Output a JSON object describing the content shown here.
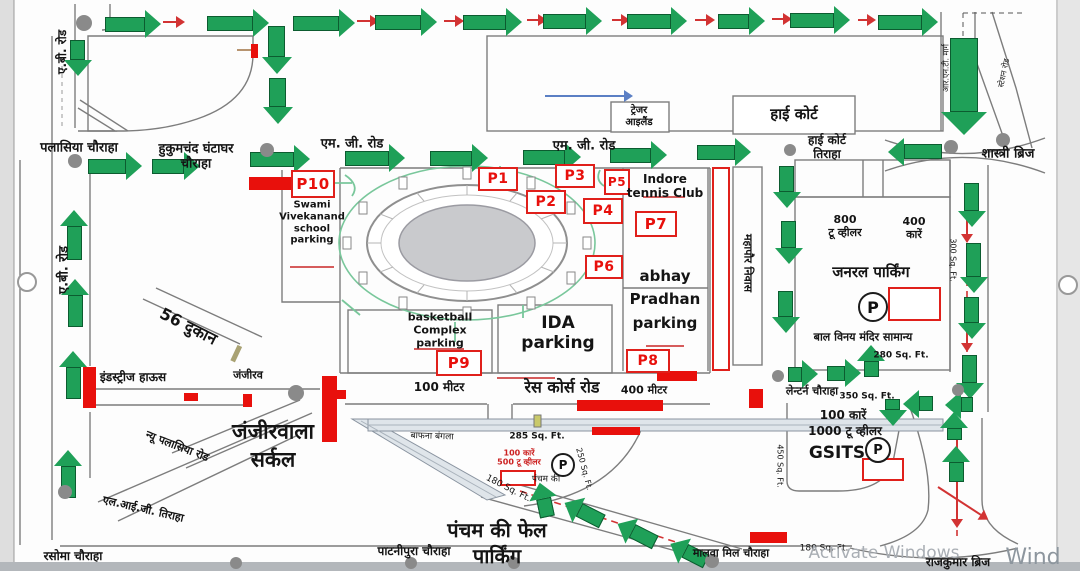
{
  "map": {
    "colors": {
      "arrow_green": "#1fa058",
      "arrow_green_dark": "#0c5c30",
      "barricade_red": "#e8100c",
      "dash_red": "#d23333",
      "flow_blue": "#5b7fc4",
      "island_gray": "#8a8a8a",
      "watermark_gray": "#a9aeb4"
    },
    "labels": [
      {
        "n": "label-ab-road-top",
        "t": "ए.बी. रोड",
        "x": 62,
        "y": 52,
        "fs": 12,
        "rot": -90,
        "fw": 700
      },
      {
        "n": "label-ab-road",
        "t": "ए.बी. रोड",
        "x": 64,
        "y": 270,
        "fs": 13,
        "rot": -90,
        "fw": 700
      },
      {
        "n": "label-palasia-chauraha",
        "t": "पलासिया चौराहा",
        "x": 79,
        "y": 148,
        "fs": 13,
        "fw": 700
      },
      {
        "n": "label-hukumchand-ghantaghar-chauraha",
        "t": "हुकुमचंद घंटाघर\nचौराहा",
        "x": 196,
        "y": 157,
        "fs": 13,
        "fw": 700
      },
      {
        "n": "label-mg-road-1",
        "t": "एम. जी. रोड",
        "x": 352,
        "y": 144,
        "fs": 13,
        "fw": 700
      },
      {
        "n": "label-mg-road-2",
        "t": "एम. जी. रोड",
        "x": 584,
        "y": 146,
        "fs": 13,
        "fw": 700
      },
      {
        "n": "label-treasure-island",
        "t": "ट्रेजर\nआइलैंड",
        "x": 639,
        "y": 117,
        "fs": 10,
        "fw": 700
      },
      {
        "n": "label-high-court",
        "t": "हाई कोर्ट",
        "x": 794,
        "y": 115,
        "fs": 15,
        "fw": 700
      },
      {
        "n": "label-high-court-tiraha",
        "t": "हाई कोर्ट\nतिराहा",
        "x": 827,
        "y": 147,
        "fs": 12,
        "fw": 700
      },
      {
        "n": "label-shastri-bridge",
        "t": "शास्त्री ब्रिज",
        "x": 1008,
        "y": 154,
        "fs": 13,
        "fw": 700
      },
      {
        "n": "label-rnt-marg",
        "t": "आर.एन.टी. मार्ग",
        "x": 946,
        "y": 68,
        "fs": 8,
        "rot": -90
      },
      {
        "n": "label-station-road",
        "t": "स्टेशन रोड",
        "x": 1004,
        "y": 73,
        "fs": 8,
        "rot": -78
      },
      {
        "n": "label-mahapaur-niwas",
        "t": "महापौर निवास",
        "x": 747,
        "y": 263,
        "fs": 11,
        "rot": 90,
        "fw": 700
      },
      {
        "n": "label-indore-tennis-club",
        "t": "Indore\ntennis Club",
        "x": 665,
        "y": 186,
        "fs": 12,
        "fw": 700
      },
      {
        "n": "label-abhay-pradhan-parking",
        "t": "abhay\nPradhan\nparking",
        "x": 665,
        "y": 300,
        "fs": 15,
        "fw": 700,
        "lh": 1.55
      },
      {
        "n": "label-ida-parking",
        "t": "IDA\nparking",
        "x": 558,
        "y": 333,
        "fs": 17,
        "fw": 700
      },
      {
        "n": "label-basketball-complex-parking",
        "t": "basketball\nComplex\nparking",
        "x": 440,
        "y": 331,
        "fs": 11,
        "fw": 700
      },
      {
        "n": "label-swami-vivekanand-school-parking",
        "t": "Swami\nVivekanand\nschool\nparking",
        "x": 312,
        "y": 223,
        "fs": 10,
        "fw": 700
      },
      {
        "n": "label-800-two-wheeler",
        "t": "800\nटू व्हीलर",
        "x": 845,
        "y": 227,
        "fs": 11,
        "fw": 700
      },
      {
        "n": "label-400-cars",
        "t": "400\nकारें",
        "x": 914,
        "y": 229,
        "fs": 11,
        "fw": 700
      },
      {
        "n": "label-general-parking",
        "t": "जनरल पार्किंग",
        "x": 871,
        "y": 273,
        "fs": 15,
        "fw": 700
      },
      {
        "n": "label-bal-vinay-mandir-samanya",
        "t": "बाल विनय मंदिर सामान्य",
        "x": 863,
        "y": 338,
        "fs": 11,
        "fw": 700
      },
      {
        "n": "label-280-sqft",
        "t": "280 Sq. Ft.",
        "x": 901,
        "y": 356,
        "fs": 9,
        "fw": 700
      },
      {
        "n": "label-300-sqft",
        "t": "300 Sq. Ft.",
        "x": 953,
        "y": 260,
        "fs": 8,
        "rot": 90
      },
      {
        "n": "label-56-dukan",
        "t": "56 दुकान",
        "x": 188,
        "y": 327,
        "fs": 16,
        "rot": 27,
        "fw": 700
      },
      {
        "n": "label-industries-house",
        "t": "इंडस्ट्रीज हाऊस",
        "x": 133,
        "y": 377,
        "fs": 12,
        "fw": 700
      },
      {
        "n": "label-janjeer-street",
        "t": "जंजीरव",
        "x": 248,
        "y": 376,
        "fs": 11,
        "fw": 700
      },
      {
        "n": "label-janjeerwala-circle",
        "t": "जंजीरवाला\nसर्कल",
        "x": 273,
        "y": 446,
        "fs": 21,
        "fw": 700,
        "lh": 1.35
      },
      {
        "n": "label-new-palasia-road",
        "t": "न्यू पलासिया रोड",
        "x": 177,
        "y": 447,
        "fs": 11,
        "rot": 21,
        "fw": 700
      },
      {
        "n": "label-lig-tiraha",
        "t": "एल.आई.जी. तिराहा",
        "x": 143,
        "y": 510,
        "fs": 11,
        "rot": 13,
        "fw": 700
      },
      {
        "n": "label-rasoma-chauraha",
        "t": "रसोमा चौराहा",
        "x": 73,
        "y": 556,
        "fs": 12,
        "fw": 700
      },
      {
        "n": "label-patnipura-chauraha",
        "t": "पाटनीपुरा चौराहा",
        "x": 414,
        "y": 551,
        "fs": 12,
        "fw": 700
      },
      {
        "n": "label-pancham-ki-phel-parking",
        "t": "पंचम की फेल\nपार्किंग",
        "x": 497,
        "y": 543,
        "fs": 20,
        "fw": 700,
        "lh": 1.3
      },
      {
        "n": "label-malwa-mill-chauraha",
        "t": "मालवा मिल चौराहा",
        "x": 731,
        "y": 554,
        "fs": 11,
        "fw": 700
      },
      {
        "n": "label-rajkumar-bridge",
        "t": "राजकुमार ब्रिज",
        "x": 958,
        "y": 562,
        "fs": 12,
        "fw": 700
      },
      {
        "n": "label-race-course-road",
        "t": "रेस कोर्स रोड",
        "x": 562,
        "y": 388,
        "fs": 16,
        "fw": 700
      },
      {
        "n": "label-100-meter",
        "t": "100 मीटर",
        "x": 439,
        "y": 387,
        "fs": 12,
        "fw": 700
      },
      {
        "n": "label-400-meter",
        "t": "400 मीटर",
        "x": 644,
        "y": 391,
        "fs": 11,
        "fw": 700
      },
      {
        "n": "label-lantern-chauraha",
        "t": "लेन्टर्न चौराहा",
        "x": 812,
        "y": 392,
        "fs": 11,
        "fw": 700
      },
      {
        "n": "label-350-sqft",
        "t": "350 Sq. Ft.",
        "x": 867,
        "y": 397,
        "fs": 9,
        "fw": 700
      },
      {
        "n": "label-100-cars",
        "t": "100 कारें",
        "x": 843,
        "y": 415,
        "fs": 12,
        "fw": 700
      },
      {
        "n": "label-1000-two-wheeler",
        "t": "1000 टू व्हीलर",
        "x": 845,
        "y": 431,
        "fs": 12,
        "fw": 700
      },
      {
        "n": "label-gsits",
        "t": "GSITS",
        "x": 837,
        "y": 453,
        "fs": 17,
        "fw": 700
      },
      {
        "n": "label-450-sqft",
        "t": "450 Sq. Ft.",
        "x": 780,
        "y": 466,
        "fs": 8,
        "rot": 90
      },
      {
        "n": "label-285-sqft",
        "t": "285 Sq. Ft.",
        "x": 537,
        "y": 437,
        "fs": 9,
        "fw": 700
      },
      {
        "n": "label-100-cars-500-two-wheeler",
        "t": "100 कारें\n500 टू व्हीलर",
        "x": 519,
        "y": 458,
        "fs": 8,
        "col": "#cc2222",
        "fw": 700
      },
      {
        "n": "label-pancham-ki",
        "t": "पंचम की",
        "x": 546,
        "y": 480,
        "fs": 9
      },
      {
        "n": "label-250-sqft",
        "t": "250 Sq. Ft.",
        "x": 584,
        "y": 469,
        "fs": 8,
        "rot": 75
      },
      {
        "n": "label-180-sqft-1",
        "t": "180 Sq. Ft.",
        "x": 508,
        "y": 489,
        "fs": 9,
        "rot": 27
      },
      {
        "n": "label-180-sqft-2",
        "t": "180 Sq. Ft.",
        "x": 824,
        "y": 549,
        "fs": 9
      },
      {
        "n": "label-bafna-bangla",
        "t": "बाफना बंगला",
        "x": 432,
        "y": 437,
        "fs": 9,
        "rot": 2
      },
      {
        "n": "watermark-activate-windows",
        "t": "Activate Windows",
        "x": 884,
        "y": 553,
        "fs": 17,
        "col": "#a9aeb4"
      },
      {
        "n": "watermark-wind",
        "t": "Wind",
        "x": 1033,
        "y": 558,
        "fs": 22,
        "col": "#8d969e"
      }
    ],
    "p_markers": [
      {
        "id": "P10",
        "x": 291,
        "y": 170,
        "w": 40,
        "h": 24,
        "fs": 15
      },
      {
        "id": "P1",
        "x": 478,
        "y": 167,
        "w": 36,
        "h": 20,
        "fs": 14
      },
      {
        "id": "P3",
        "x": 555,
        "y": 164,
        "w": 36,
        "h": 20,
        "fs": 14
      },
      {
        "id": "P5",
        "x": 604,
        "y": 169,
        "w": 22,
        "h": 22,
        "fs": 12
      },
      {
        "id": "P2",
        "x": 526,
        "y": 190,
        "w": 36,
        "h": 20,
        "fs": 14
      },
      {
        "id": "P4",
        "x": 583,
        "y": 198,
        "w": 36,
        "h": 22,
        "fs": 14
      },
      {
        "id": "P7",
        "x": 635,
        "y": 211,
        "w": 38,
        "h": 22,
        "fs": 15
      },
      {
        "id": "P6",
        "x": 585,
        "y": 255,
        "w": 34,
        "h": 20,
        "fs": 14
      },
      {
        "id": "P9",
        "x": 436,
        "y": 350,
        "w": 42,
        "h": 22,
        "fs": 15
      },
      {
        "id": "P8",
        "x": 626,
        "y": 349,
        "w": 40,
        "h": 20,
        "fs": 14
      }
    ],
    "p_circles": [
      {
        "sym": "P",
        "x": 871,
        "y": 305,
        "d": 26,
        "fs": 16
      },
      {
        "sym": "P",
        "x": 561,
        "y": 463,
        "d": 20,
        "fs": 12
      },
      {
        "sym": "P",
        "x": 876,
        "y": 448,
        "d": 22,
        "fs": 13
      }
    ],
    "arrows_green": [
      {
        "x": 105,
        "y": 24,
        "len": 54,
        "rot": 0
      },
      {
        "x": 207,
        "y": 23,
        "len": 60,
        "rot": 0
      },
      {
        "x": 293,
        "y": 23,
        "len": 60,
        "rot": 0
      },
      {
        "x": 375,
        "y": 22,
        "len": 60,
        "rot": 0
      },
      {
        "x": 463,
        "y": 22,
        "len": 57,
        "rot": 0
      },
      {
        "x": 543,
        "y": 21,
        "len": 57,
        "rot": 0
      },
      {
        "x": 627,
        "y": 21,
        "len": 58,
        "rot": 0
      },
      {
        "x": 718,
        "y": 21,
        "len": 45,
        "rot": 0
      },
      {
        "x": 790,
        "y": 20,
        "len": 58,
        "rot": 0
      },
      {
        "x": 878,
        "y": 22,
        "len": 58,
        "rot": 0
      },
      {
        "x": 78,
        "y": 40,
        "len": 34,
        "rot": 90
      },
      {
        "x": 277,
        "y": 26,
        "len": 46,
        "rot": 90,
        "w": 15
      },
      {
        "x": 278,
        "y": 78,
        "len": 44,
        "rot": 90,
        "w": 15
      },
      {
        "x": 74,
        "y": 260,
        "len": 48,
        "rot": -90
      },
      {
        "x": 75,
        "y": 327,
        "len": 46,
        "rot": -90
      },
      {
        "x": 73,
        "y": 399,
        "len": 46,
        "rot": -90
      },
      {
        "x": 68,
        "y": 498,
        "len": 46,
        "rot": -90
      },
      {
        "x": 88,
        "y": 166,
        "len": 52,
        "rot": 0
      },
      {
        "x": 152,
        "y": 166,
        "len": 46,
        "rot": 0
      },
      {
        "x": 250,
        "y": 159,
        "len": 58,
        "rot": 0
      },
      {
        "x": 345,
        "y": 158,
        "len": 58,
        "rot": 0
      },
      {
        "x": 430,
        "y": 158,
        "len": 56,
        "rot": 0
      },
      {
        "x": 523,
        "y": 157,
        "len": 56,
        "rot": 0
      },
      {
        "x": 610,
        "y": 155,
        "len": 55,
        "rot": 0
      },
      {
        "x": 697,
        "y": 152,
        "len": 52,
        "rot": 0
      },
      {
        "x": 942,
        "y": 152,
        "len": 52,
        "rot": 180
      },
      {
        "x": 964,
        "y": 38,
        "len": 95,
        "rot": 90,
        "w": 26
      },
      {
        "x": 972,
        "y": 183,
        "len": 42,
        "rot": 90
      },
      {
        "x": 974,
        "y": 243,
        "len": 48,
        "rot": 90
      },
      {
        "x": 972,
        "y": 297,
        "len": 40,
        "rot": 90
      },
      {
        "x": 970,
        "y": 355,
        "len": 42,
        "rot": 90
      },
      {
        "x": 787,
        "y": 166,
        "len": 40,
        "rot": 90
      },
      {
        "x": 789,
        "y": 221,
        "len": 41,
        "rot": 90
      },
      {
        "x": 786,
        "y": 291,
        "len": 40,
        "rot": 90
      },
      {
        "x": 871,
        "y": 377,
        "len": 30,
        "rot": -90
      },
      {
        "x": 788,
        "y": 374,
        "len": 28,
        "rot": 0
      },
      {
        "x": 827,
        "y": 373,
        "len": 32,
        "rot": 0
      },
      {
        "x": 933,
        "y": 404,
        "len": 28,
        "rot": 180
      },
      {
        "x": 973,
        "y": 405,
        "len": 26,
        "rot": 180
      },
      {
        "x": 893,
        "y": 399,
        "len": 25,
        "rot": 90
      },
      {
        "x": 954,
        "y": 440,
        "len": 26,
        "rot": -90
      },
      {
        "x": 956,
        "y": 482,
        "len": 34,
        "rot": -90
      },
      {
        "x": 547,
        "y": 517,
        "len": 33,
        "rot": 258
      },
      {
        "x": 602,
        "y": 522,
        "len": 40,
        "rot": 207
      },
      {
        "x": 655,
        "y": 543,
        "len": 40,
        "rot": 207
      },
      {
        "x": 706,
        "y": 562,
        "len": 38,
        "rot": 207
      }
    ],
    "arrows_red": [
      {
        "x": 163,
        "y": 22,
        "len": 22,
        "rot": 0
      },
      {
        "x": 357,
        "y": 21,
        "len": 22,
        "rot": 0
      },
      {
        "x": 444,
        "y": 21,
        "len": 20,
        "rot": 0
      },
      {
        "x": 527,
        "y": 20,
        "len": 20,
        "rot": 0
      },
      {
        "x": 612,
        "y": 20,
        "len": 18,
        "rot": 0
      },
      {
        "x": 695,
        "y": 20,
        "len": 20,
        "rot": 0
      },
      {
        "x": 772,
        "y": 19,
        "len": 20,
        "rot": 0
      },
      {
        "x": 858,
        "y": 20,
        "len": 18,
        "rot": 0
      },
      {
        "x": 967,
        "y": 205,
        "len": 38,
        "rot": 90
      },
      {
        "x": 967,
        "y": 308,
        "len": 44,
        "rot": 90
      },
      {
        "x": 957,
        "y": 428,
        "len": 36,
        "rot": 90
      },
      {
        "x": 957,
        "y": 480,
        "len": 48,
        "rot": 90
      },
      {
        "x": 938,
        "y": 487,
        "len": 60,
        "rot": 33
      },
      {
        "x": 568,
        "y": 505,
        "len": 24,
        "rot": 27
      },
      {
        "x": 622,
        "y": 526,
        "len": 24,
        "rot": 27
      },
      {
        "x": 676,
        "y": 546,
        "len": 24,
        "rot": 27
      }
    ],
    "arrows_blue": [
      {
        "x": 545,
        "y": 96,
        "len": 88,
        "rot": 0
      }
    ],
    "barricades": [
      {
        "x": 249,
        "y": 177,
        "w": 46,
        "h": 13
      },
      {
        "x": 83,
        "y": 367,
        "w": 13,
        "h": 41
      },
      {
        "x": 184,
        "y": 393,
        "w": 14,
        "h": 8
      },
      {
        "x": 243,
        "y": 394,
        "w": 9,
        "h": 13
      },
      {
        "x": 322,
        "y": 376,
        "w": 15,
        "h": 66
      },
      {
        "x": 337,
        "y": 390,
        "w": 9,
        "h": 9
      },
      {
        "x": 577,
        "y": 400,
        "w": 86,
        "h": 11
      },
      {
        "x": 592,
        "y": 427,
        "w": 48,
        "h": 8
      },
      {
        "x": 657,
        "y": 371,
        "w": 40,
        "h": 10
      },
      {
        "x": 749,
        "y": 389,
        "w": 14,
        "h": 19
      },
      {
        "x": 750,
        "y": 532,
        "w": 37,
        "h": 11
      },
      {
        "x": 251,
        "y": 44,
        "w": 7,
        "h": 14
      }
    ],
    "red_outline_boxes": [
      {
        "x": 712,
        "y": 167,
        "w": 14,
        "h": 200
      },
      {
        "x": 888,
        "y": 287,
        "w": 49,
        "h": 30
      },
      {
        "x": 862,
        "y": 458,
        "w": 38,
        "h": 19
      },
      {
        "x": 500,
        "y": 470,
        "w": 32,
        "h": 12
      }
    ],
    "islands_gray": [
      {
        "x": 84,
        "y": 23,
        "r": 8
      },
      {
        "x": 75,
        "y": 161,
        "r": 7
      },
      {
        "x": 267,
        "y": 150,
        "r": 7
      },
      {
        "x": 790,
        "y": 150,
        "r": 6
      },
      {
        "x": 951,
        "y": 147,
        "r": 7
      },
      {
        "x": 1003,
        "y": 140,
        "r": 7
      },
      {
        "x": 296,
        "y": 393,
        "r": 8
      },
      {
        "x": 65,
        "y": 492,
        "r": 7
      },
      {
        "x": 778,
        "y": 376,
        "r": 6
      },
      {
        "x": 958,
        "y": 390,
        "r": 6
      },
      {
        "x": 236,
        "y": 563,
        "r": 6
      },
      {
        "x": 411,
        "y": 563,
        "r": 6
      },
      {
        "x": 514,
        "y": 563,
        "r": 6
      },
      {
        "x": 712,
        "y": 561,
        "r": 7
      }
    ],
    "page_dots": [
      {
        "x": 25,
        "y": 280,
        "r": 8
      },
      {
        "x": 1066,
        "y": 283,
        "r": 8
      }
    ]
  }
}
